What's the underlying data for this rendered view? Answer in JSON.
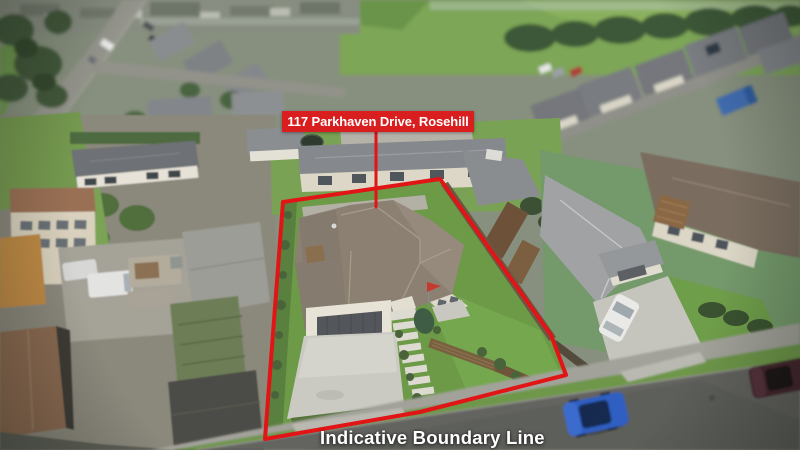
{
  "meta": {
    "description": "Aerial drone photograph of a residential property in an overcast suburban neighbourhood, with a red indicative boundary overlay around the section"
  },
  "overlay": {
    "address_label": "117 Parkhaven Drive, Rosehill",
    "boundary_caption": "Indicative Boundary Line",
    "banner_color": "#d81e1e",
    "line_color": "#e11515",
    "text_color": "#ffffff",
    "boundary_points": "283,202 440,179 551,335 566,375 420,412 265,439",
    "pointer_path": "M376,131 L376,207"
  }
}
